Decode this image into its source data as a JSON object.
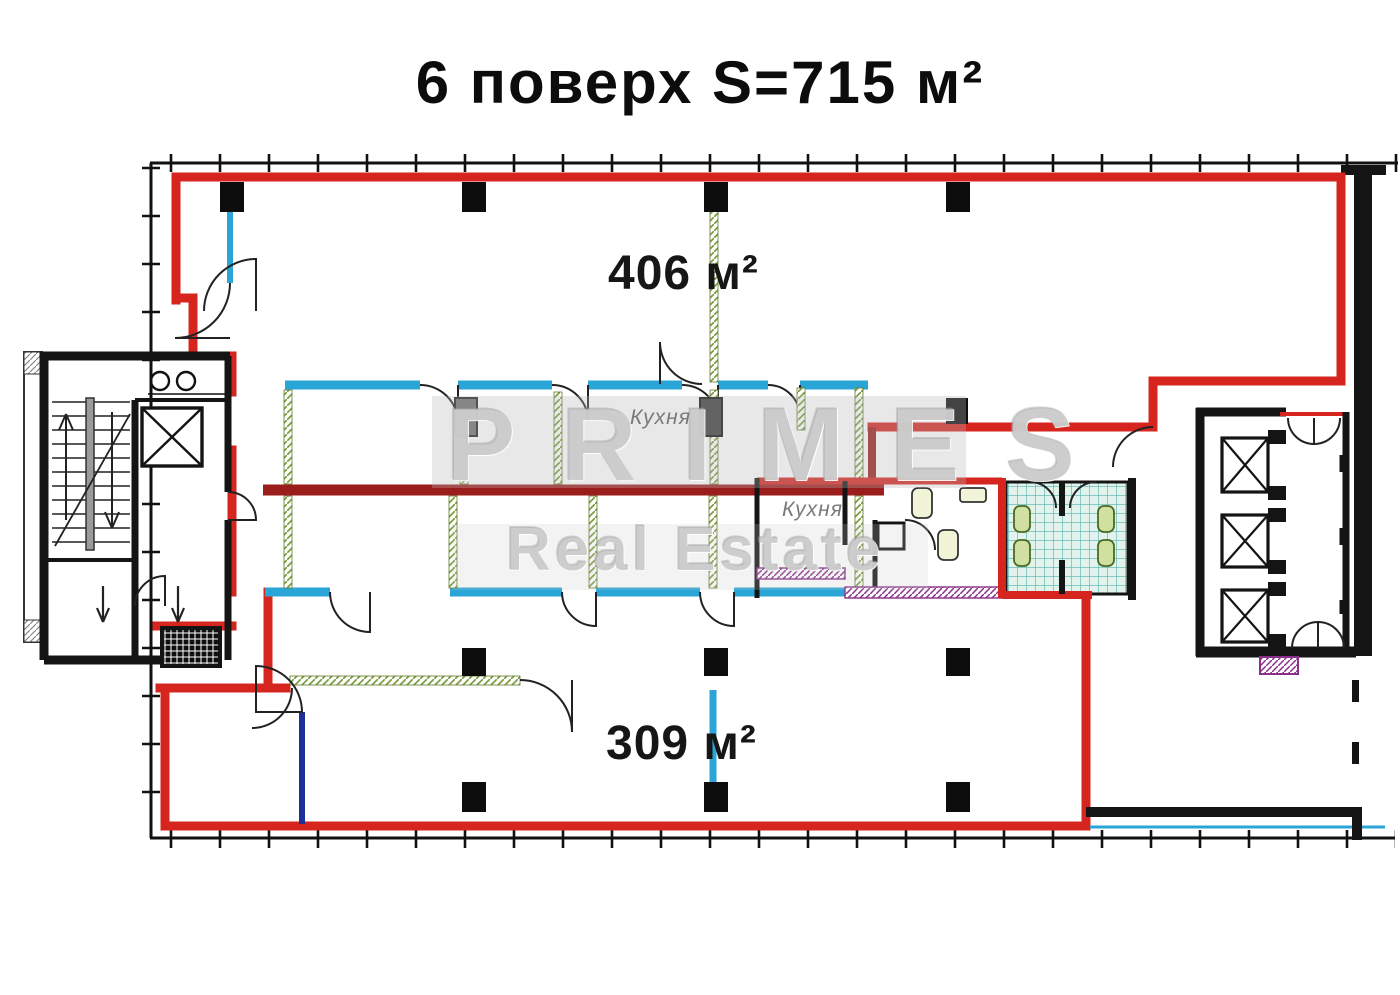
{
  "title": "6 поверх S=715 м²",
  "areas": {
    "upper": "406 м²",
    "lower": "309 м²"
  },
  "rooms": {
    "kitchen1": "Кухня",
    "kitchen2": "Кухня"
  },
  "watermark": {
    "line1": "PRIMES",
    "line2": "Real Estate"
  },
  "colors": {
    "outline_red": "#d6251f",
    "mid_wall_dark_red": "#9b1d1b",
    "wall_black": "#141414",
    "partition_light_blue": "#2aa5d8",
    "line_navy": "#1e2f9a",
    "column_hatch_green": "#7d9c3e",
    "tile_teal": "#52b3ab",
    "plumbing_purple": "#8a2f8a",
    "watermark_gray": "#b0b0b0"
  }
}
